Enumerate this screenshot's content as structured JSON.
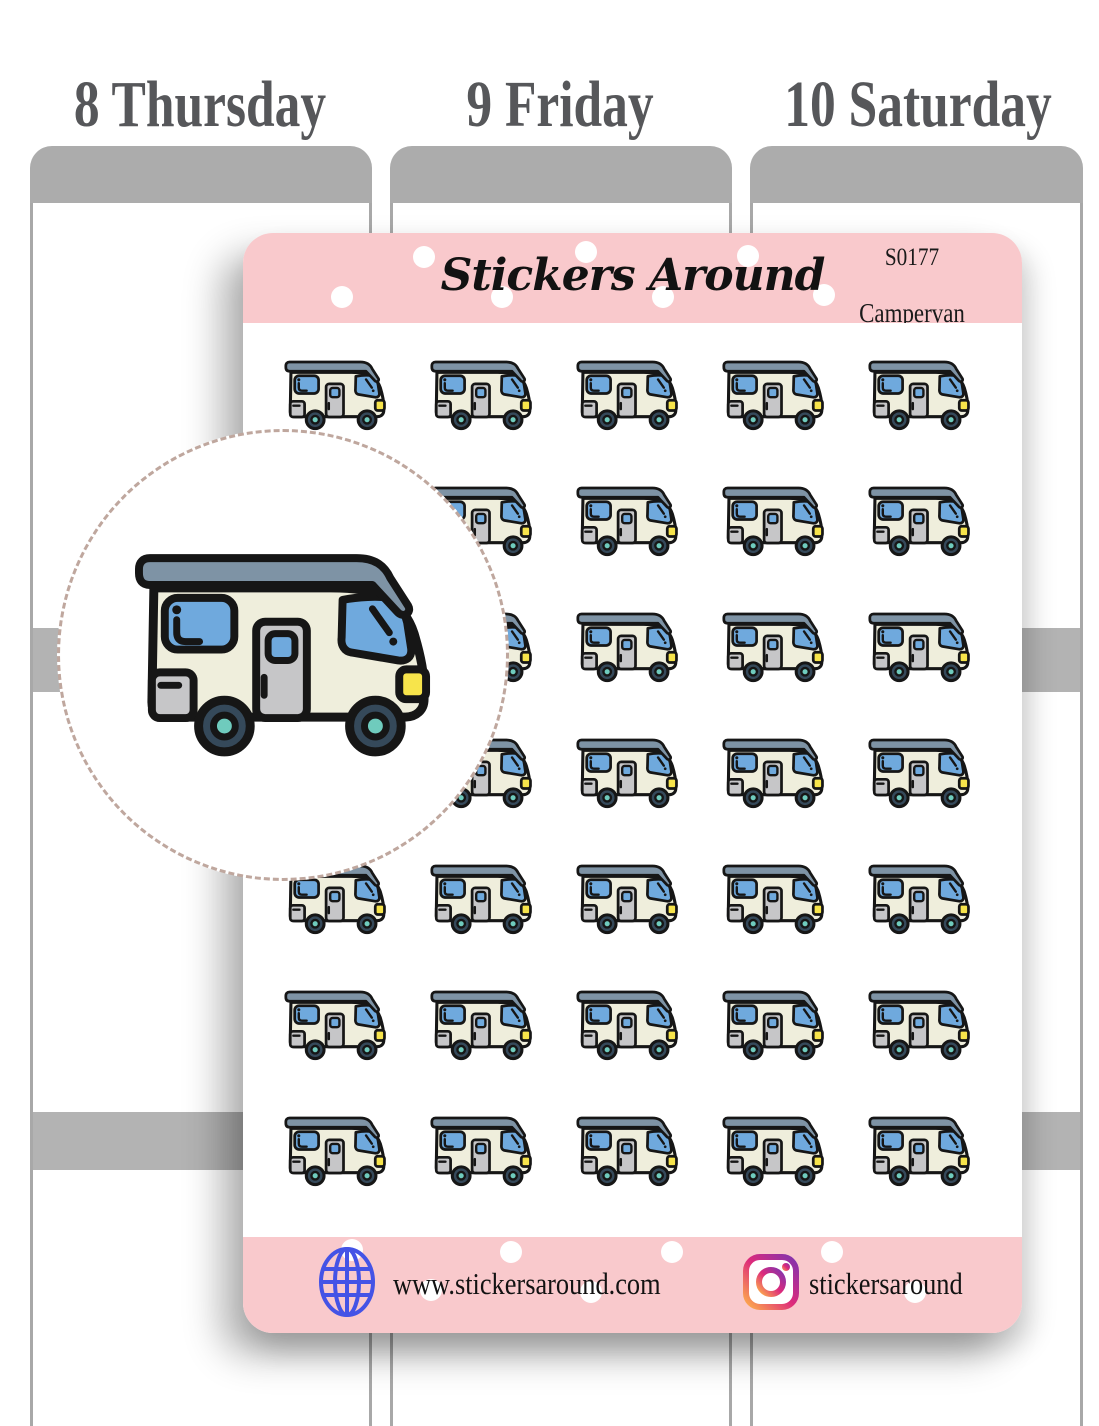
{
  "planner": {
    "days": [
      {
        "label": "8 Thursday"
      },
      {
        "label": "9 Friday"
      },
      {
        "label": "10 Saturday"
      }
    ]
  },
  "sheet": {
    "brand": "Stickers Around",
    "code": "S0177",
    "product_name": "Campervan",
    "sticker_name": "campervan-sticker",
    "grid": {
      "rows": 7,
      "cols": 5
    },
    "footer": {
      "website": "www.stickersaround.com",
      "instagram_handle": "stickersaround"
    },
    "header_dots": [
      [
        181,
        24
      ],
      [
        343,
        19
      ],
      [
        505,
        23
      ],
      [
        99,
        64
      ],
      [
        259,
        64
      ],
      [
        420,
        64
      ],
      [
        581,
        62
      ]
    ],
    "footer_dots": [
      [
        109,
        13
      ],
      [
        188,
        53
      ],
      [
        268,
        15
      ],
      [
        348,
        55
      ],
      [
        429,
        15
      ],
      [
        589,
        15
      ],
      [
        672,
        55
      ]
    ]
  },
  "colors": {
    "sheet_pink": "#F9C9CC",
    "camper_body": "#EFEEDC",
    "camper_roof": "#7E93A5",
    "window_blue": "#6FA9DD",
    "door_gray": "#C6C6C8",
    "wheel_dark": "#35495A",
    "wheel_hub_teal": "#6FCBBD",
    "headlight_yellow": "#F7E44B",
    "outline_black": "#161616",
    "planner_gray": "#ACACAC",
    "globe_blue": "#4453E6",
    "instagram_gradient": [
      "#8134AF",
      "#DD2A7B",
      "#FEAE4B"
    ],
    "circle_dash": "#BFA79E"
  }
}
